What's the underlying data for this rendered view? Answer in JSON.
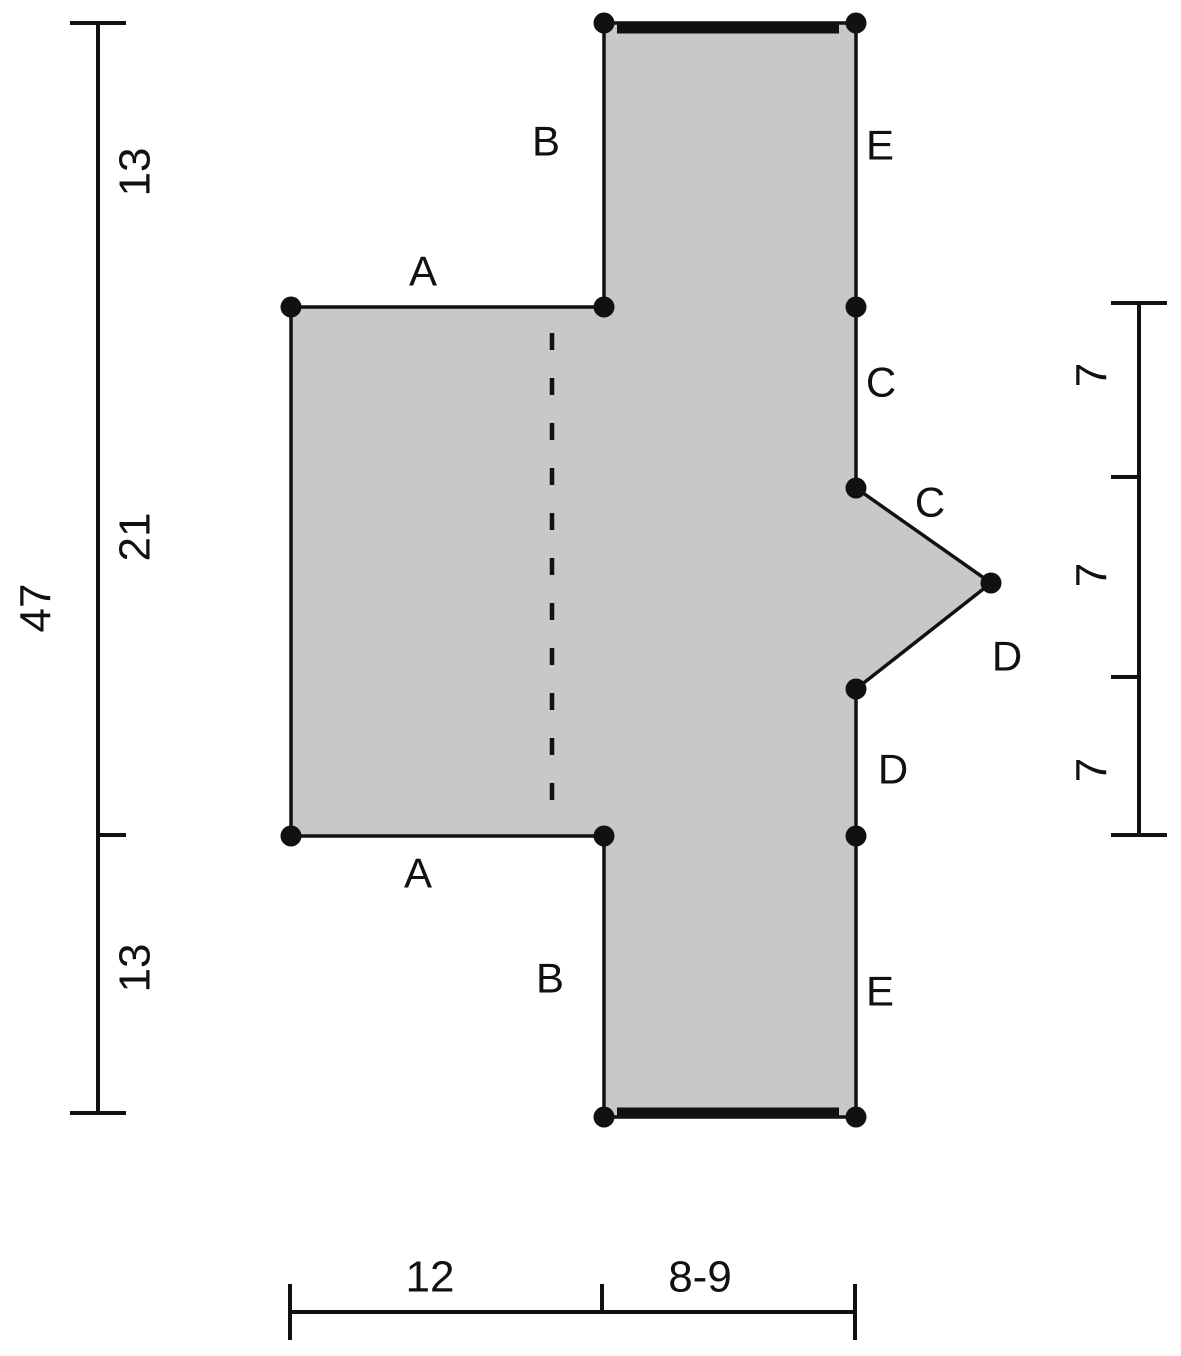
{
  "canvas": {
    "width": 1181,
    "height": 1356,
    "background": "#ffffff"
  },
  "style": {
    "fill_color": "#c8c8c8",
    "line_color": "#111111",
    "outline_width": 3.5,
    "dim_line_width": 4,
    "bold_edge_width": 9,
    "dot_radius": 10.5,
    "edge_label_font_size": 42,
    "number_font_size": 44
  },
  "panel": {
    "name": "garment-panel-outline",
    "outline_points": [
      [
        604,
        23
      ],
      [
        856,
        23
      ],
      [
        856,
        488
      ],
      [
        991,
        583
      ],
      [
        856,
        689
      ],
      [
        856,
        1117
      ],
      [
        604,
        1117
      ],
      [
        604,
        836
      ],
      [
        291,
        836
      ],
      [
        291,
        307
      ],
      [
        604,
        307
      ]
    ],
    "fold_line": {
      "name": "center-fold-dashed-line",
      "x1": 552,
      "y1": 333,
      "x2": 552,
      "y2": 812,
      "dash": "17 28",
      "width": 4.5
    },
    "bold_edges": [
      {
        "name": "bold-edge-top",
        "x1": 617,
        "y1": 29,
        "x2": 839,
        "y2": 29
      },
      {
        "name": "bold-edge-bottom",
        "x1": 617,
        "y1": 1112,
        "x2": 839,
        "y2": 1112
      }
    ],
    "vertex_dots": [
      [
        604,
        23
      ],
      [
        856,
        23
      ],
      [
        291,
        307
      ],
      [
        604,
        307
      ],
      [
        856,
        307
      ],
      [
        856,
        488
      ],
      [
        991,
        583
      ],
      [
        856,
        689
      ],
      [
        291,
        836
      ],
      [
        604,
        836
      ],
      [
        856,
        836
      ],
      [
        604,
        1117
      ],
      [
        856,
        1117
      ]
    ]
  },
  "edge_labels": [
    {
      "name": "edge-label-B-top",
      "text": "B",
      "x": 546,
      "y": 141
    },
    {
      "name": "edge-label-E-top",
      "text": "E",
      "x": 880,
      "y": 145
    },
    {
      "name": "edge-label-A-top",
      "text": "A",
      "x": 423,
      "y": 271
    },
    {
      "name": "edge-label-C-side",
      "text": "C",
      "x": 881,
      "y": 382
    },
    {
      "name": "edge-label-C-diagonal",
      "text": "C",
      "x": 930,
      "y": 502
    },
    {
      "name": "edge-label-D-diagonal",
      "text": "D",
      "x": 1007,
      "y": 656
    },
    {
      "name": "edge-label-D-side",
      "text": "D",
      "x": 893,
      "y": 769
    },
    {
      "name": "edge-label-A-bottom",
      "text": "A",
      "x": 418,
      "y": 873
    },
    {
      "name": "edge-label-B-bottom",
      "text": "B",
      "x": 550,
      "y": 978
    },
    {
      "name": "edge-label-E-bottom",
      "text": "E",
      "x": 880,
      "y": 991
    }
  ],
  "dimension_lines": [
    {
      "name": "left-vertical-dimension",
      "axis": {
        "x1": 98,
        "y1": 23,
        "x2": 98,
        "y2": 1113
      },
      "ticks": [
        {
          "x1": 70,
          "y1": 23,
          "x2": 126,
          "y2": 23
        },
        {
          "x1": 70,
          "y1": 1113,
          "x2": 126,
          "y2": 1113
        },
        {
          "x1": 98,
          "y1": 835,
          "x2": 126,
          "y2": 835
        }
      ],
      "labels": [
        {
          "name": "dim-label-13-top",
          "text": "13",
          "x": 135,
          "y": 172,
          "rotate": -90
        },
        {
          "name": "dim-label-21",
          "text": "21",
          "x": 135,
          "y": 537,
          "rotate": -90
        },
        {
          "name": "dim-label-13-bottom",
          "text": "13",
          "x": 135,
          "y": 968,
          "rotate": -90
        },
        {
          "name": "dim-label-47-total",
          "text": "47",
          "x": 36,
          "y": 608,
          "rotate": -90
        }
      ]
    },
    {
      "name": "right-vertical-dimension",
      "axis": {
        "x1": 1139,
        "y1": 303,
        "x2": 1139,
        "y2": 835
      },
      "ticks": [
        {
          "x1": 1111,
          "y1": 303,
          "x2": 1167,
          "y2": 303
        },
        {
          "x1": 1111,
          "y1": 835,
          "x2": 1167,
          "y2": 835
        },
        {
          "x1": 1111,
          "y1": 477,
          "x2": 1139,
          "y2": 477
        },
        {
          "x1": 1111,
          "y1": 677,
          "x2": 1139,
          "y2": 677
        }
      ],
      "labels": [
        {
          "name": "dim-label-7-top",
          "text": "7",
          "x": 1092,
          "y": 375,
          "rotate": -90
        },
        {
          "name": "dim-label-7-middle",
          "text": "7",
          "x": 1092,
          "y": 575,
          "rotate": -90
        },
        {
          "name": "dim-label-7-bottom",
          "text": "7",
          "x": 1092,
          "y": 770,
          "rotate": -90
        }
      ]
    },
    {
      "name": "bottom-horizontal-dimension",
      "axis": {
        "x1": 290,
        "y1": 1312,
        "x2": 855,
        "y2": 1312
      },
      "ticks": [
        {
          "x1": 290,
          "y1": 1284,
          "x2": 290,
          "y2": 1340
        },
        {
          "x1": 855,
          "y1": 1284,
          "x2": 855,
          "y2": 1340
        },
        {
          "x1": 602,
          "y1": 1284,
          "x2": 602,
          "y2": 1312
        }
      ],
      "labels": [
        {
          "name": "dim-label-12",
          "text": "12",
          "x": 430,
          "y": 1277,
          "rotate": 0
        },
        {
          "name": "dim-label-8-9",
          "text": "8-9",
          "x": 700,
          "y": 1277,
          "rotate": 0
        }
      ]
    }
  ]
}
